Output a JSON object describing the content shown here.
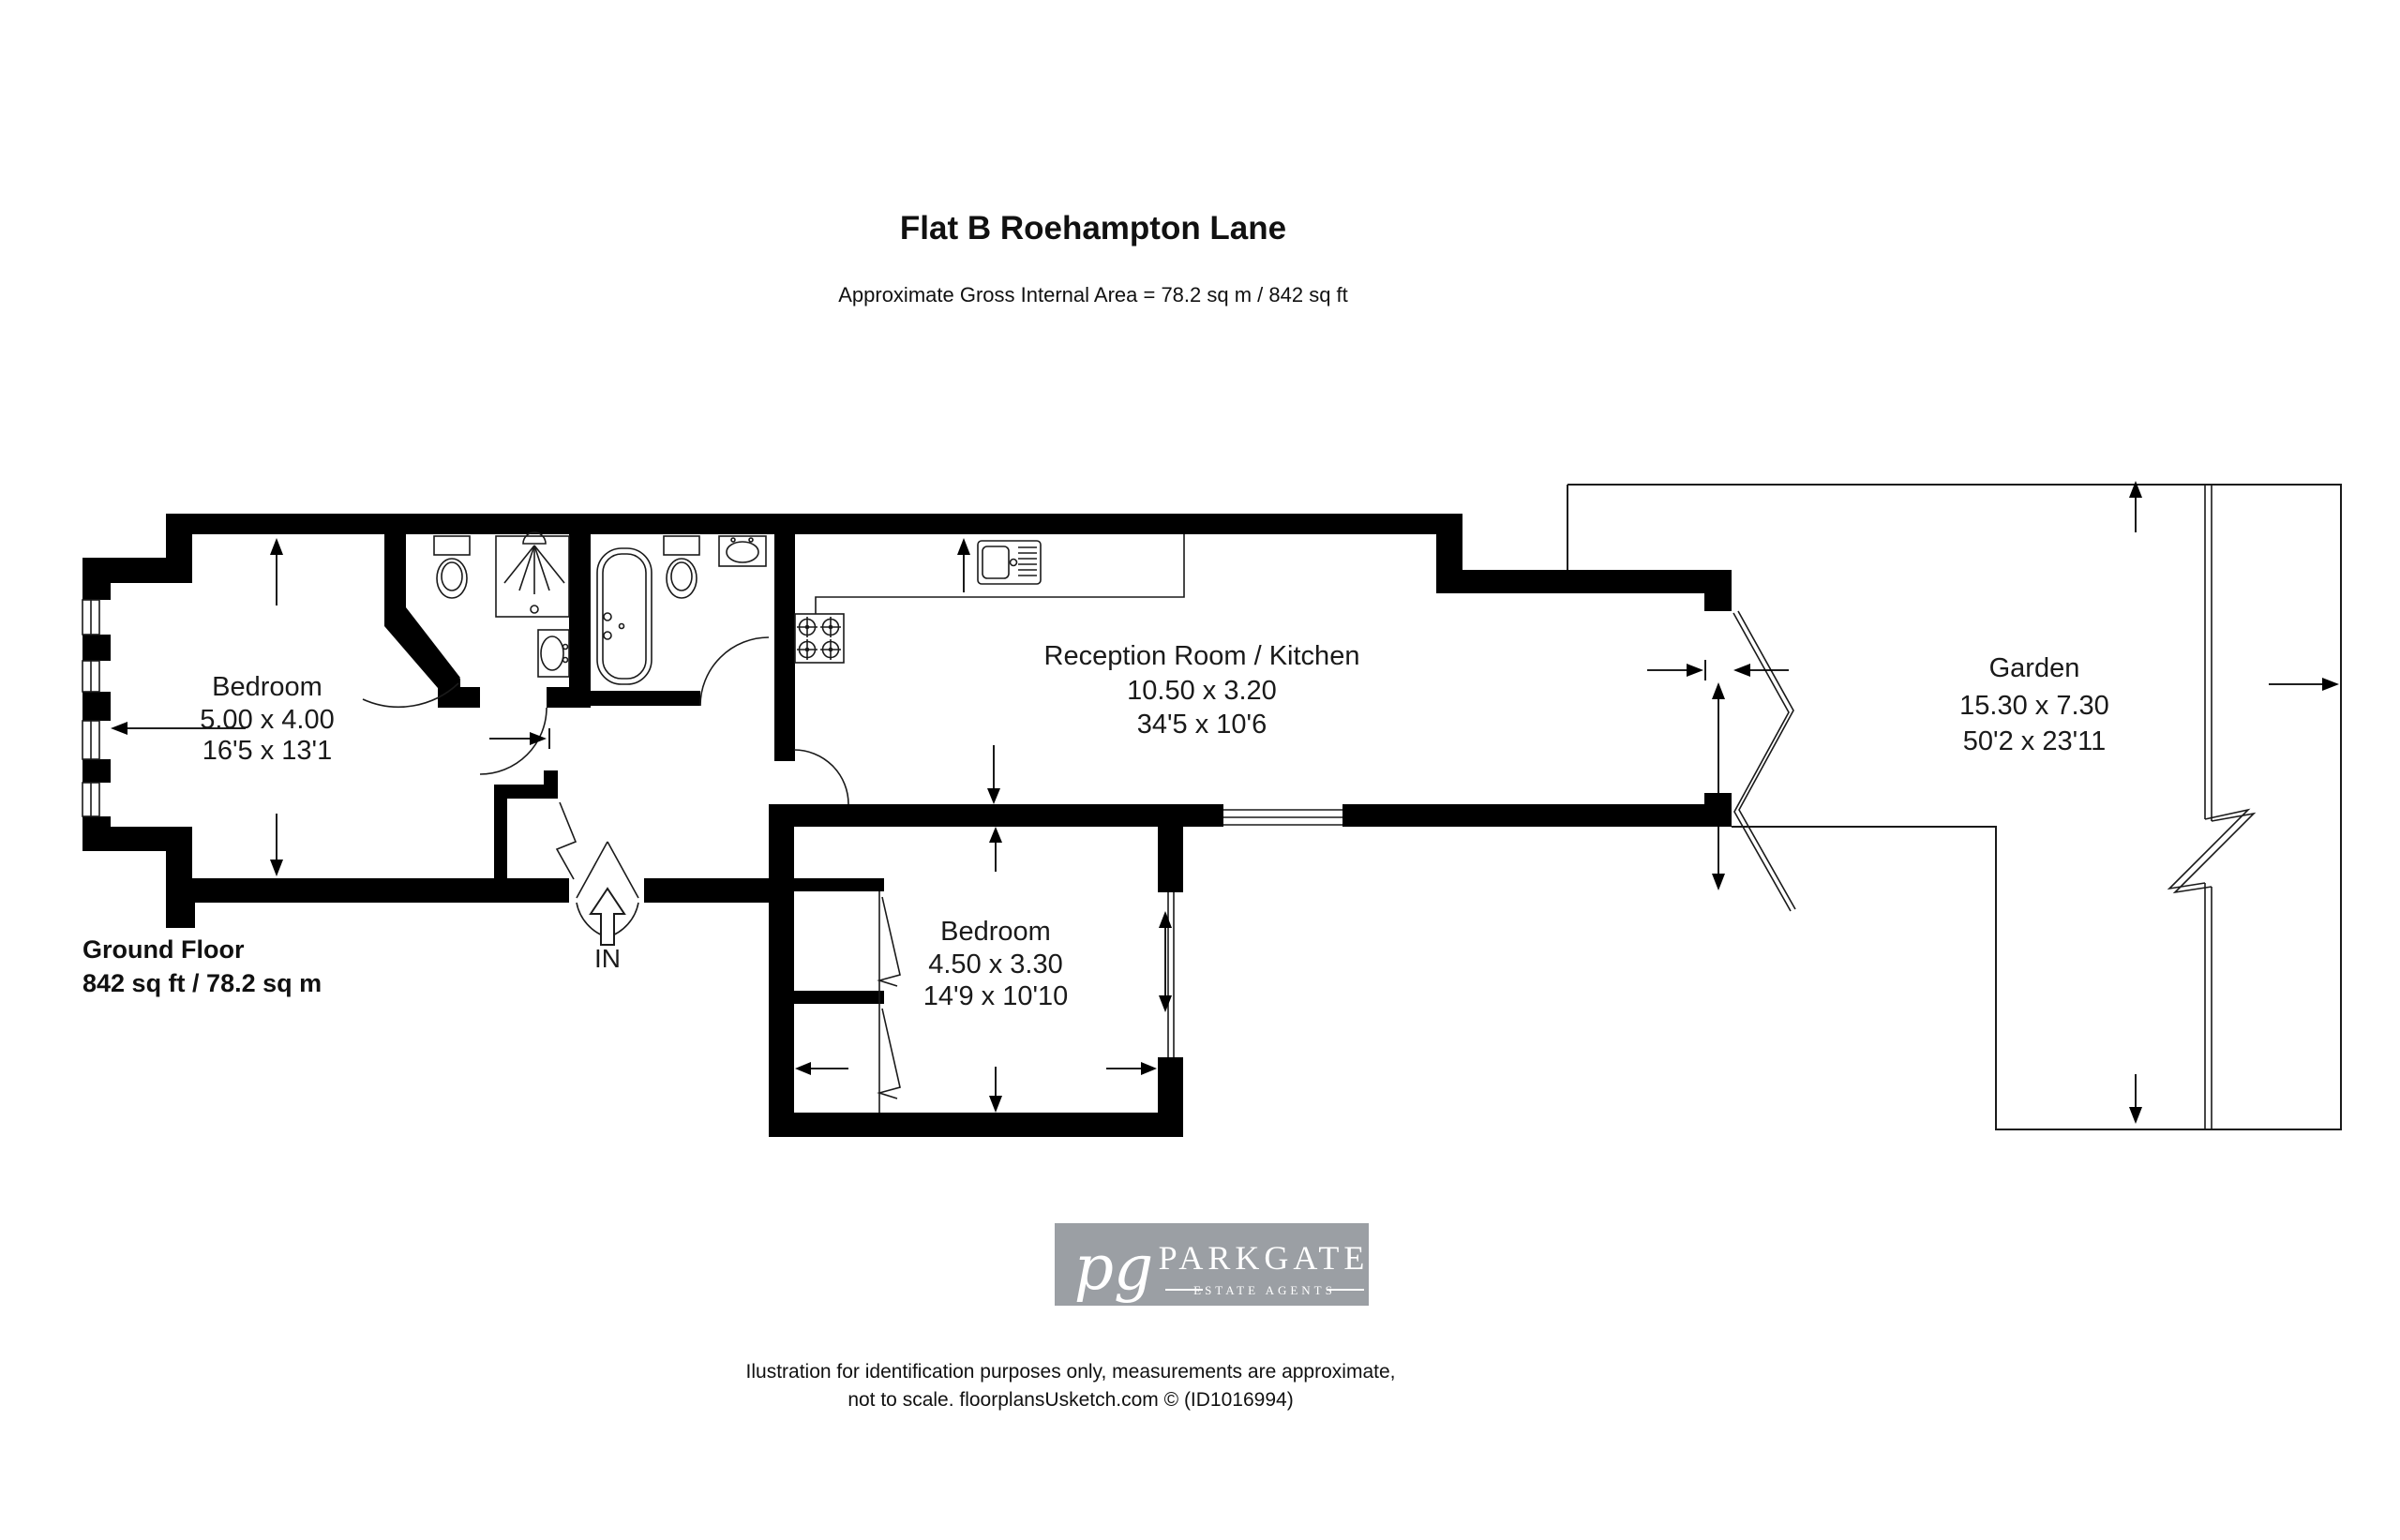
{
  "title": "Flat B Roehampton Lane",
  "subtitle": "Approximate Gross Internal Area = 78.2 sq m / 842 sq ft",
  "floor": {
    "label": "Ground Floor",
    "area": "842 sq ft / 78.2 sq m"
  },
  "entrance_label": "IN",
  "rooms": {
    "bedroom1": {
      "name": "Bedroom",
      "metric": "5.00 x 4.00",
      "imperial": "16'5 x 13'1"
    },
    "reception": {
      "name": "Reception Room / Kitchen",
      "metric": "10.50 x 3.20",
      "imperial": "34'5 x 10'6"
    },
    "bedroom2": {
      "name": "Bedroom",
      "metric": "4.50 x 3.30",
      "imperial": "14'9 x 10'10"
    },
    "garden": {
      "name": "Garden",
      "metric": "15.30 x 7.30",
      "imperial": "50'2 x 23'11"
    }
  },
  "logo": {
    "initials": "pg",
    "name": "PARKGATE",
    "tagline": "ESTATE AGENTS",
    "bg_color": "#9b9fa4",
    "text_color": "#ffffff"
  },
  "footer": {
    "line1": "Ilustration for identification purposes only, measurements are approximate,",
    "line2": "not to scale. floorplansUsketch.com © (ID1016994)"
  },
  "colors": {
    "wall": "#000000",
    "line": "#1a1a1a",
    "logo_bg": "#9b9fa4"
  }
}
